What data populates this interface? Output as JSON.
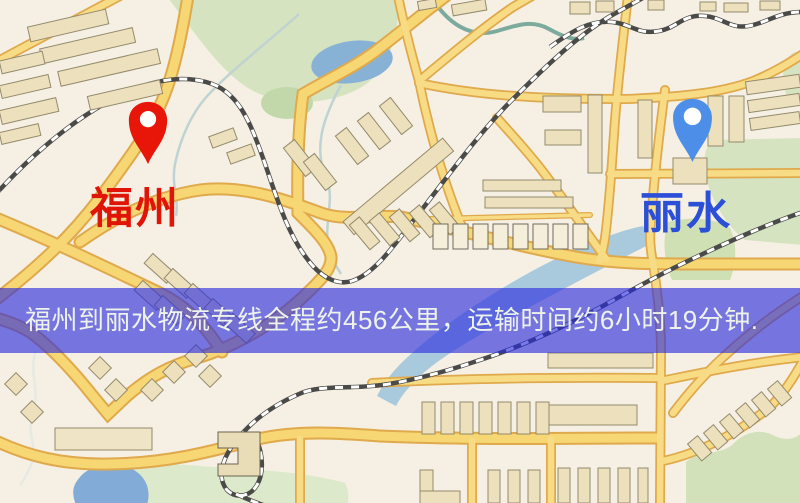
{
  "banner": {
    "text": "福州到丽水物流专线全程约456公里，运输时间约6小时19分钟.",
    "overlay_color": "#2a2cde"
  },
  "route": {
    "origin": "福州",
    "destination": "丽水",
    "distance_km": 456,
    "duration_text": "6小时19分钟"
  },
  "locations": {
    "origin": {
      "name": "福州",
      "pin_color": "#e81608",
      "label_color": "#e11408"
    },
    "destination": {
      "name": "丽水",
      "pin_color": "#4d8fe8",
      "label_color": "#2b4fd6"
    }
  },
  "map": {
    "palette": {
      "background": "#f5f0e3",
      "road_fill": "#f7d674",
      "road_casing": "#dfa94c",
      "park_green": "#d6e3c0",
      "water_blue": "#8fb8da",
      "railway_dark": "#4a4a48"
    }
  }
}
